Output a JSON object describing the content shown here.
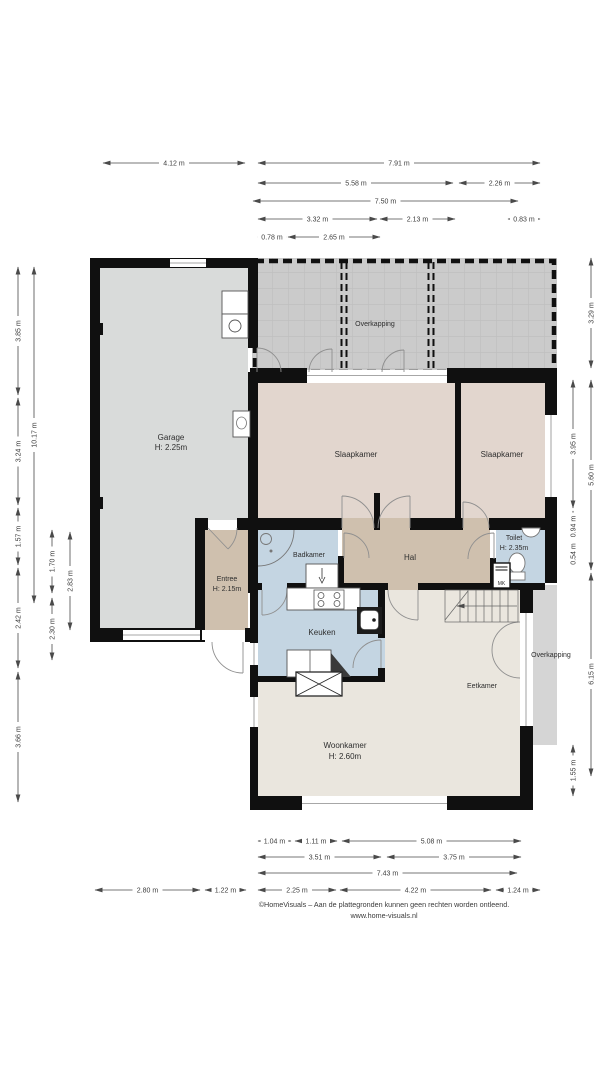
{
  "colors": {
    "wall": "#101010",
    "garage_floor": "#d9dbda",
    "bedroom_floor": "#e2d6ce",
    "hall_floor": "#cfc0ae",
    "wet_room_floor": "#c4d5e2",
    "living_floor": "#eae6de",
    "overkapping": "#cbcbcb",
    "overkapping_right": "#d5d5d5"
  },
  "rooms": {
    "garage": {
      "name": "Garage",
      "height": "H: 2.25m"
    },
    "slaapkamer_left": {
      "name": "Slaapkamer"
    },
    "slaapkamer_right": {
      "name": "Slaapkamer"
    },
    "overkapping_top": {
      "name": "Overkapping"
    },
    "overkapping_right": {
      "name": "Overkapping"
    },
    "entree": {
      "name": "Entree",
      "height": "H: 2.15m"
    },
    "badkamer": {
      "name": "Badkamer"
    },
    "hal": {
      "name": "Hal"
    },
    "toilet": {
      "name": "Toilet",
      "height": "H: 2.35m"
    },
    "meterkast": {
      "name": "MK"
    },
    "keuken": {
      "name": "Keuken"
    },
    "woonkamer": {
      "name": "Woonkamer",
      "height": "H: 2.60m"
    },
    "eetkamer": {
      "name": "Eetkamer"
    }
  },
  "dims_top": [
    "4.12 m",
    "7.91 m",
    "5.58 m",
    "2.26 m",
    "7.50 m",
    "3.32 m",
    "2.13 m",
    "0.83 m",
    "0.78 m",
    "2.65 m"
  ],
  "dims_bottom": [
    "1.04 m",
    "1.11 m",
    "5.08 m",
    "3.51 m",
    "3.75 m",
    "7.43 m",
    "2.80 m",
    "1.22 m",
    "2.25 m",
    "4.22 m",
    "1.24 m"
  ],
  "dims_left": [
    "3.85 m",
    "3.24 m",
    "1.57 m",
    "2.42 m",
    "3.66 m",
    "10.17 m",
    "1.70 m",
    "2.30 m",
    "2.83 m"
  ],
  "dims_right": [
    "3.29 m",
    "3.95 m",
    "0.94 m",
    "0.54 m",
    "5.60 m",
    "6.15 m",
    "1.55 m"
  ],
  "footer": {
    "disclaimer": "©HomeVisuals – Aan de plattegronden kunnen geen rechten worden ontleend.",
    "website": "www.home-visuals.nl"
  }
}
